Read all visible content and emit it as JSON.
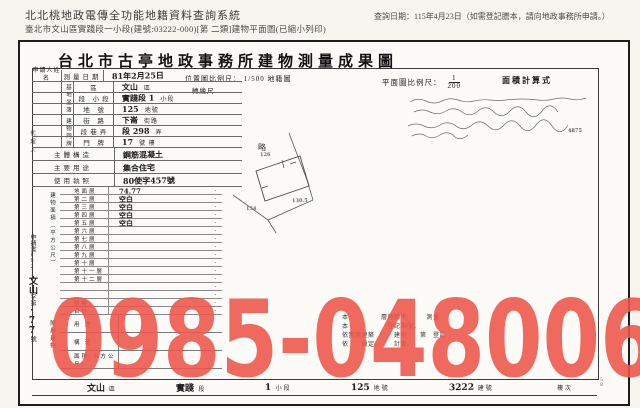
{
  "header": {
    "system_title": "北北桃地政電傳全功能地籍資料查詢系統",
    "query_subject": "臺北市文山區實踐段一小段(建號:03222-000)[第 二類]建物平面圖(已縮小列印)",
    "query_date": "查詢日期：115年4月23日（如需登記謄本，請向地政事務所申請。）"
  },
  "watermark": {
    "text": "0985-048006",
    "color": "#ee544a"
  },
  "doc": {
    "title": "台北市古亭地政事務所建物測量成果圖",
    "side": {
      "agent": "代理人",
      "page_no": "58",
      "application_parts": [
        {
          "t": "申請書",
          "cls": "p"
        },
        {
          "t": "(82)",
          "cls": "p"
        },
        {
          "t": "文山",
          "cls": "hw"
        },
        {
          "t": "字第",
          "cls": "p"
        },
        {
          "t": "·77",
          "cls": "hw"
        },
        {
          "t": "號",
          "cls": "p"
        }
      ]
    },
    "scales": {
      "location_label": "位置圖比例尺：",
      "location_value": "1/500",
      "location_suffix": "地籍圖",
      "location_suffix2": "轉繪尺",
      "plan_label": "平面圖比例尺：",
      "plan_num": "1",
      "plan_den": "200",
      "calc_label": "面積計算式",
      "calc_fragment": "4875"
    },
    "form": {
      "dot": "·",
      "applicant_label": "申請人姓名",
      "survey_date_label": "測量日期",
      "survey_date_value": "81年2月25日",
      "site_group": "基地坐落",
      "bldg_group": "建物門牌",
      "top_rows": [
        {
          "label": "區",
          "value": "文山",
          "unit": "區"
        },
        {
          "label": "段 小段",
          "value": "實踐段 1",
          "unit": "小段"
        },
        {
          "label": "地 號",
          "value": "125",
          "unit": "地號"
        },
        {
          "label": "街 路",
          "value": "下崙",
          "unit": "街路"
        },
        {
          "label": "段巷弄",
          "value": "段 298",
          "unit": "弄"
        },
        {
          "label": "門 牌",
          "value": "17",
          "unit": "號  樓"
        }
      ],
      "misc_rows": [
        {
          "label": "主體構造",
          "value": "鋼筋混凝土"
        },
        {
          "label": "主要用途",
          "value": "集合住宅"
        },
        {
          "label": "使用執照",
          "value": "80使字457號"
        }
      ],
      "area_group": "建物面積（平方公尺）",
      "floors": [
        {
          "label": "地面層",
          "value": "74.77"
        },
        {
          "label": "第二層",
          "value": "空白"
        },
        {
          "label": "第三層",
          "value": "空白"
        },
        {
          "label": "第四層",
          "value": "空白"
        },
        {
          "label": "第五層",
          "value": "空白"
        },
        {
          "label": "第六層",
          "value": ""
        },
        {
          "label": "第七層",
          "value": ""
        },
        {
          "label": "第八層",
          "value": ""
        },
        {
          "label": "第九層",
          "value": ""
        },
        {
          "label": "第十層",
          "value": ""
        },
        {
          "label": "第十一層",
          "value": ""
        },
        {
          "label": "第十二層",
          "value": ""
        },
        {
          "label": "",
          "value": ""
        },
        {
          "label": "",
          "value": ""
        },
        {
          "label": "騎樓",
          "value": ""
        },
        {
          "label": "合計",
          "value": ""
        }
      ],
      "annex_group": "附屬建物",
      "annex_rows": [
        {
          "label": "用 途",
          "value": ""
        },
        {
          "label": "構 造",
          "value": ""
        },
        {
          "label": "面積(平方公尺)",
          "value": ""
        }
      ]
    },
    "sketch": {
      "main_label": "略",
      "annotations": [
        "126",
        "134",
        "130.5"
      ]
    },
    "notes": [
      "本　　　　　層建物平　　　測量",
      "本　　　　　　登記為限。",
      "依實施建築　　　建物　　第　登記",
      "依　　規定　　　計算。"
    ],
    "footer_cells": [
      {
        "hw": "文山",
        "label": "區"
      },
      {
        "hw": "實踐",
        "label": "段"
      },
      {
        "hw": "1",
        "label": "小段"
      },
      {
        "hw": "125",
        "label": "地號"
      },
      {
        "hw": "3222",
        "label": "建號"
      },
      {
        "hw": "",
        "label": "樓次"
      }
    ]
  }
}
